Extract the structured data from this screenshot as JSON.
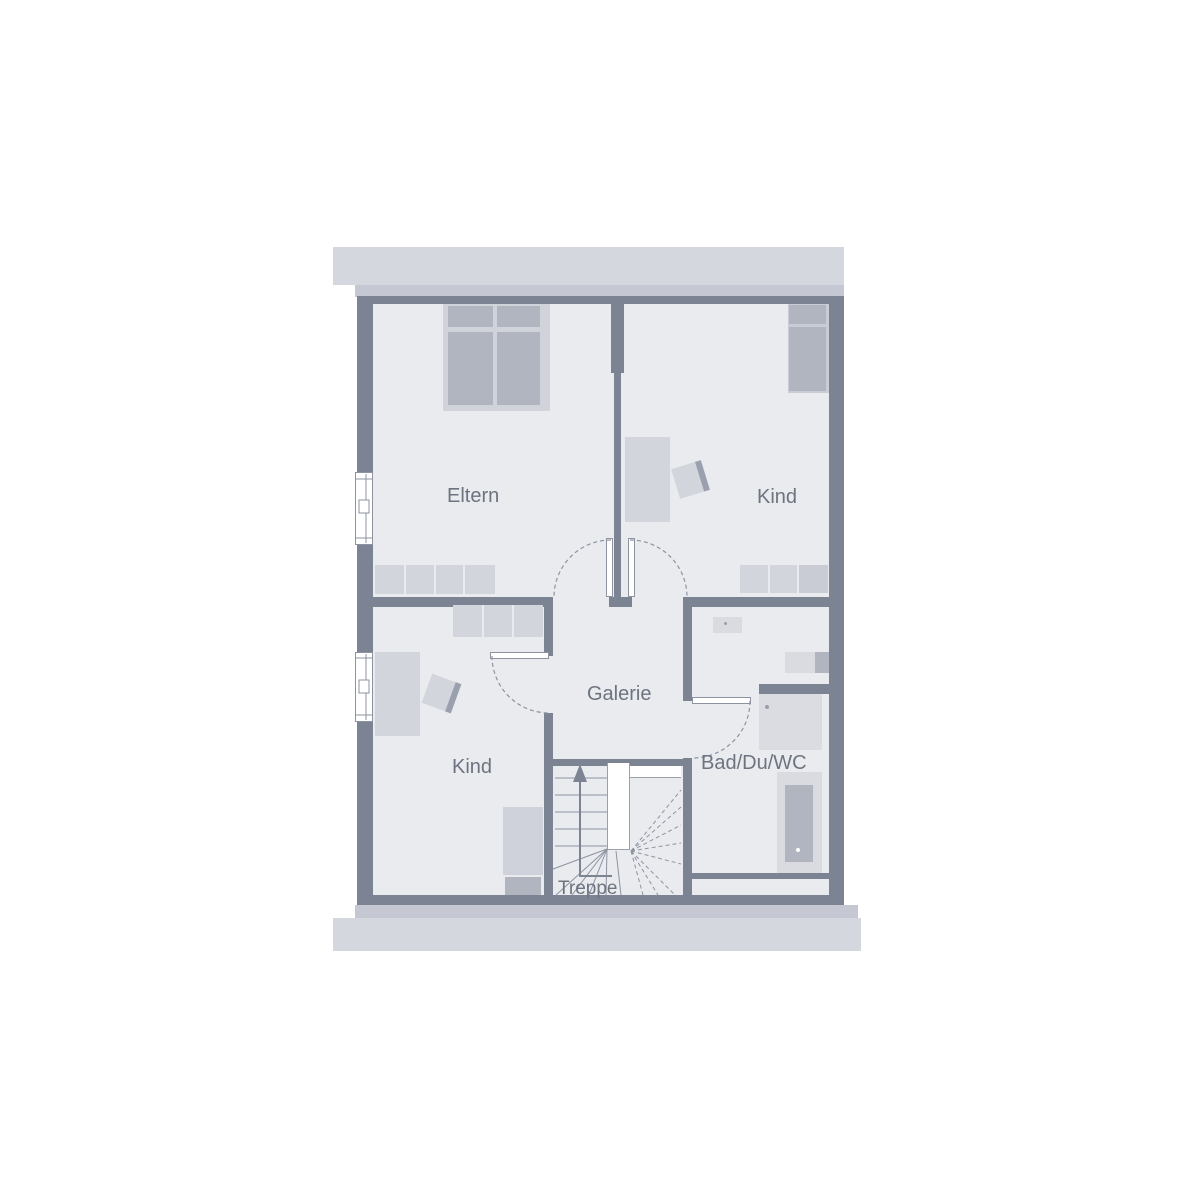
{
  "plan": {
    "type": "floor-plan-upper-storey",
    "language": "de",
    "rooms": [
      {
        "id": "eltern",
        "label": "Eltern"
      },
      {
        "id": "kind-top-right",
        "label": "Kind"
      },
      {
        "id": "kind-bottom-left",
        "label": "Kind"
      },
      {
        "id": "galerie",
        "label": "Galerie"
      },
      {
        "id": "bad",
        "label": "Bad/Du/WC"
      },
      {
        "id": "treppe",
        "label": "Treppe"
      }
    ],
    "furniture": [
      "double-bed",
      "single-bed",
      "single-bed",
      "sideboard",
      "wardrobe",
      "desk",
      "chair",
      "desk",
      "chair",
      "dresser",
      "sink",
      "toilet",
      "shower",
      "bathtub",
      "winder-staircase"
    ],
    "colors": {
      "background": "#ffffff",
      "wall": "#7c8493",
      "floor": "#e9ebef",
      "roof_band_light": "#d5d7df",
      "roof_band_dark": "#c5c8d2",
      "furniture_light": "#d2d5dc",
      "furniture_dark": "#b1b5c0",
      "fixture": "#d9dbe1",
      "line": "#8d93a1",
      "label_text": "#6d7480"
    }
  }
}
